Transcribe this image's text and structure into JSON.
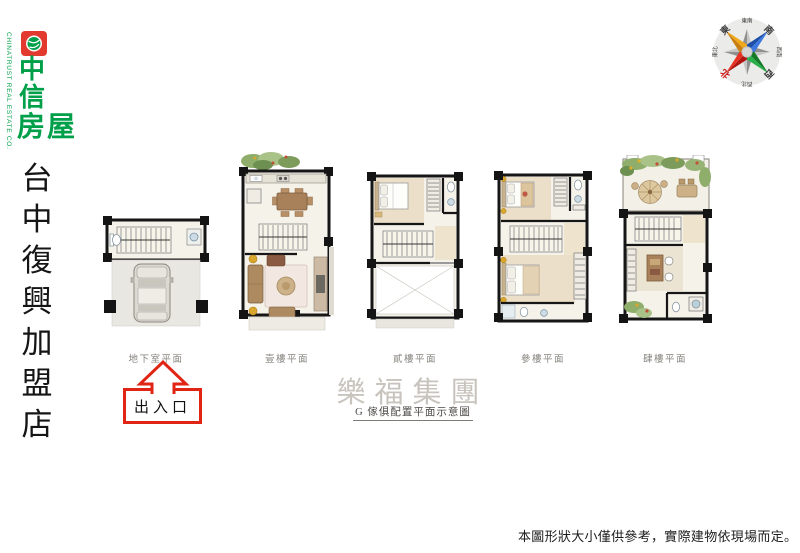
{
  "branding": {
    "company_en": "CHINATRUST REAL ESTATE CO.",
    "logo_chars": [
      "中",
      "信",
      "房",
      "屋"
    ],
    "store_name_chars": [
      "台",
      "中",
      "復",
      "興",
      "加",
      "盟",
      "店"
    ],
    "brand_green": "#00a04a",
    "brand_red": "#e23a2e"
  },
  "compass": {
    "labels": [
      {
        "text": "東南",
        "angle": 0
      },
      {
        "text": "南",
        "angle": 45
      },
      {
        "text": "西南",
        "angle": 90
      },
      {
        "text": "西",
        "angle": 135
      },
      {
        "text": "西北",
        "angle": 180
      },
      {
        "text": "北",
        "angle": 225
      },
      {
        "text": "東北",
        "angle": 270
      },
      {
        "text": "東",
        "angle": 315
      }
    ],
    "north_label_color": "#cc1111",
    "point_colors": {
      "north": "#d2281c",
      "south": "#2862c8",
      "west": "#1e9638",
      "east": "#efa11a"
    }
  },
  "plans": [
    {
      "label": "地下室平面"
    },
    {
      "label": "壹樓平面"
    },
    {
      "label": "貳樓平面"
    },
    {
      "label": "參樓平面"
    },
    {
      "label": "肆樓平面"
    }
  ],
  "entrance": {
    "label": "出入口",
    "accent_color": "#e02515"
  },
  "footer": {
    "group_name": "樂福集團",
    "caption": "G 傢俱配置平面示意圖",
    "disclaimer": "本圖形狀大小僅供參考，實際建物依現場而定。"
  }
}
